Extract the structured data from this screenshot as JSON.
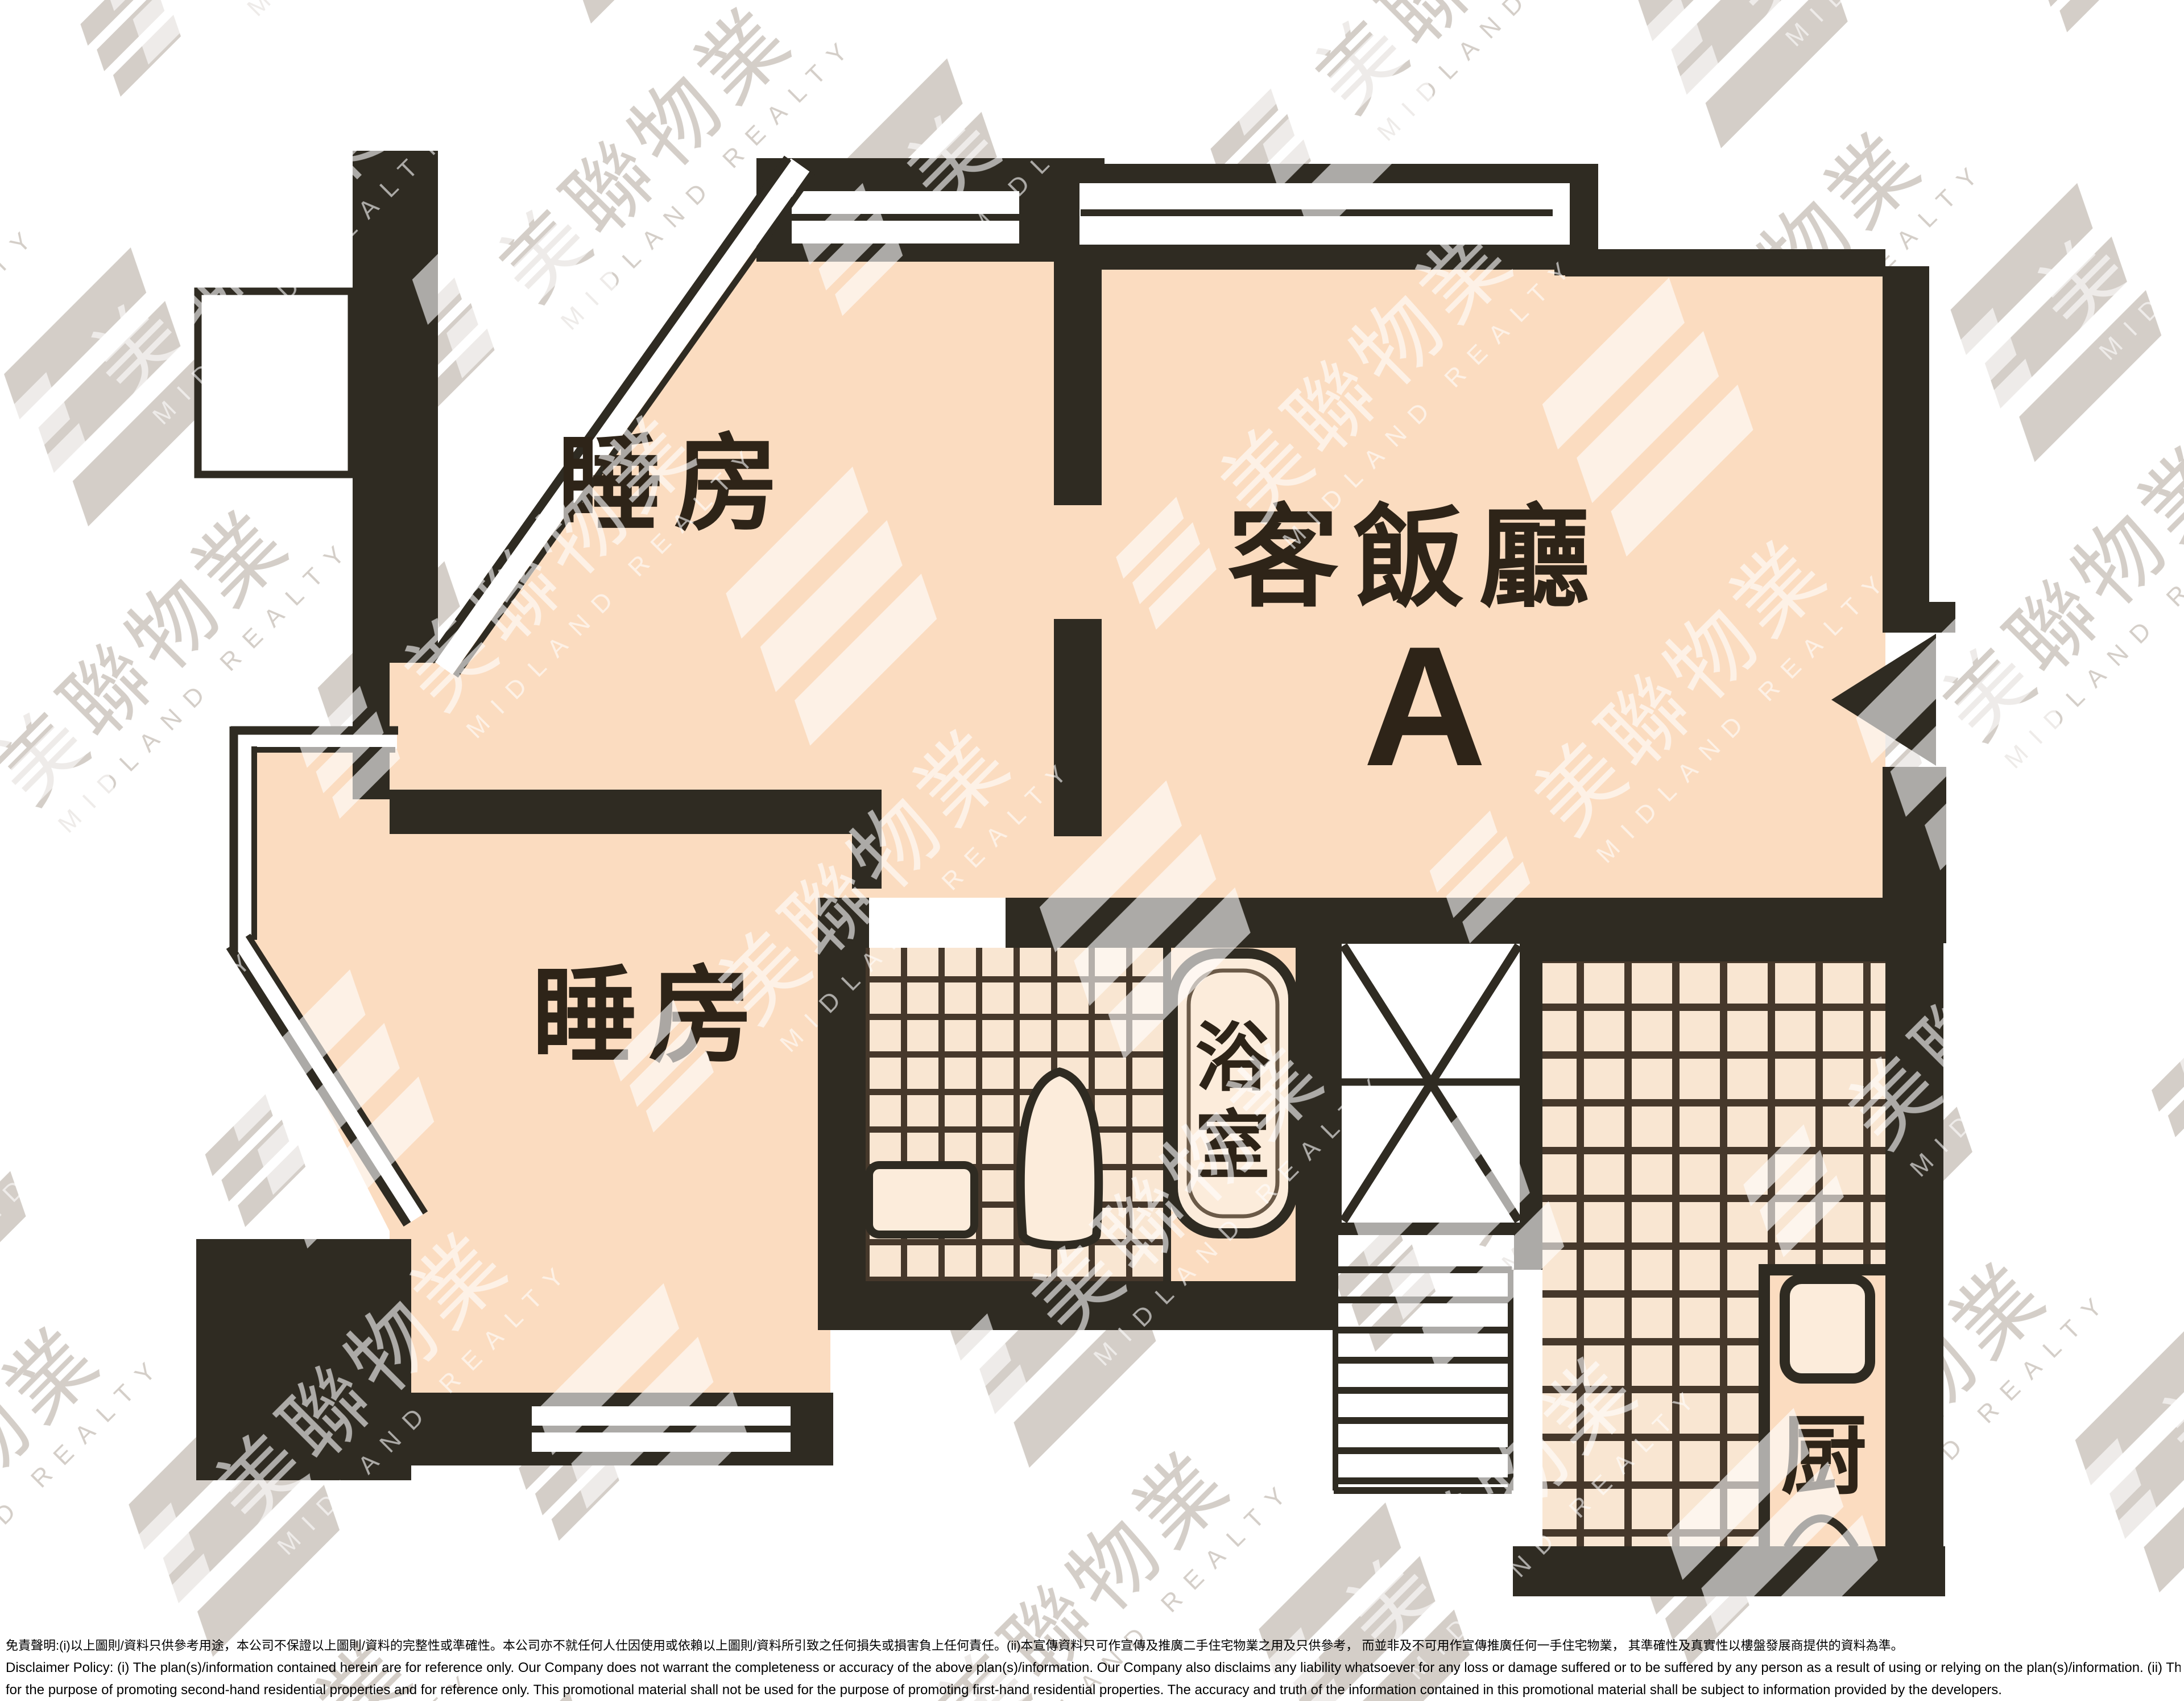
{
  "floor_plan": {
    "unit_letter": "A",
    "rooms": {
      "bedroom_top": {
        "label": "睡房"
      },
      "bedroom_bottom": {
        "label": "睡房"
      },
      "living_dining": {
        "label": "客飯廳"
      },
      "bathroom": {
        "label": "浴室",
        "label_chars": [
          "浴",
          "室"
        ]
      },
      "kitchen": {
        "label": "厨"
      }
    },
    "colors": {
      "wall": "#2f2b22",
      "floor": "#fbdcc0",
      "fixture": "#fcecdb",
      "tile_fill": "#f9e6d2",
      "tile_line": "#46382b",
      "label_text": "#2e2418",
      "outside": "#ffffff"
    }
  },
  "watermark": {
    "brand_cn": "美聯物業",
    "brand_en": "MIDLAND REALTY",
    "gray": "#cfc9c2",
    "white": "#ffffff"
  },
  "disclaimer": {
    "zh": "免責聲明:(i)以上圖則/資料只供參考用途，本公司不保證以上圖則/資料的完整性或準確性。本公司亦不就任何人仕因使用或依賴以上圖則/資料所引致之任何損失或損害負上任何責任。(ii)本宣傳資料只可作宣傳及推廣二手住宅物業之用及只供參考， 而並非及不可用作宣傳推廣任何一手住宅物業， 其準確性及真實性以樓盤發展商提供的資料為準。",
    "en_line1": "Disclaimer Policy: (i) The plan(s)/information contained herein are for reference only. Our Company does not warrant the completeness or accuracy of the above plan(s)/information. Our Company also disclaims any liability whatsoever for any loss or damage suffered or to be suffered by any person as a result of using or relying on the plan(s)/information. (ii) This promotional material is",
    "en_line2": "for the purpose of promoting second-hand residential properties and for reference only. This promotional material shall not be used for the purpose of promoting first-hand residential properties. The accuracy and truth of the information contained in this promotional material shall be subject to information provided by the developers."
  }
}
